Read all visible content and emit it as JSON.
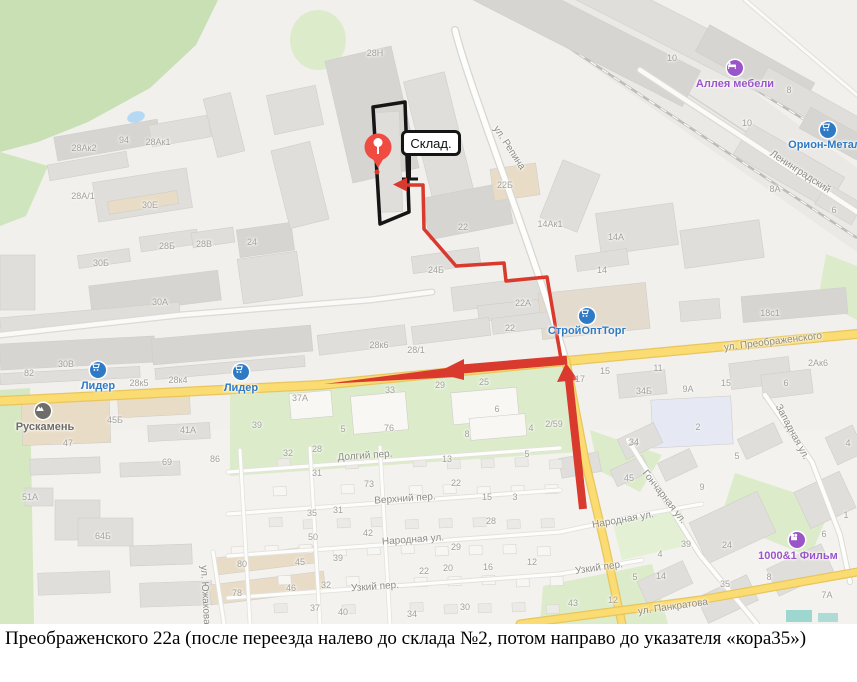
{
  "caption": "Преображенского 22а (после переезда налево до склада №2, потом направо до указателя «кора35»)",
  "map": {
    "warehouse_label": "Склад.",
    "marker": {
      "icon": "destination-pin-icon",
      "color": "#ef4b40"
    },
    "colors": {
      "route_red": "#d93a2d",
      "marker_red": "#ef4b40",
      "poi_blue": "#2f7ac4",
      "poi_purple": "#9a55c9",
      "poi_gray": "#6f6d6a",
      "road_yellow": "#fadc72",
      "green_area": "#d9ecc6"
    },
    "street_labels": [
      {
        "text": "ул. Репина",
        "x": 509,
        "y": 148,
        "angle": 57
      },
      {
        "text": "Ленинградский",
        "x": 800,
        "y": 172,
        "angle": 33
      },
      {
        "text": "ул. Преображенского",
        "x": 773,
        "y": 342,
        "angle": -7
      },
      {
        "text": "Западная ул.",
        "x": 792,
        "y": 432,
        "angle": 62
      },
      {
        "text": "Гончарная ул.",
        "x": 664,
        "y": 497,
        "angle": 52
      },
      {
        "text": "ул. Панкратова",
        "x": 673,
        "y": 607,
        "angle": -8
      },
      {
        "text": "Долгий пер.",
        "x": 365,
        "y": 456,
        "angle": -4
      },
      {
        "text": "Верхний пер.",
        "x": 405,
        "y": 499,
        "angle": -4
      },
      {
        "text": "Народная ул.",
        "x": 413,
        "y": 540,
        "angle": -4
      },
      {
        "text": "Народная ул.",
        "x": 623,
        "y": 520,
        "angle": -10
      },
      {
        "text": "Узкий пер.",
        "x": 375,
        "y": 587,
        "angle": -4
      },
      {
        "text": "Узкий пер.",
        "x": 599,
        "y": 568,
        "angle": -8
      },
      {
        "text": "ул. Южакова",
        "x": 205,
        "y": 595,
        "angle": 87
      }
    ],
    "poi_labels": [
      {
        "text": "Лидер",
        "x": 98,
        "y": 386,
        "ix": 98,
        "iy": 370,
        "color": "#2f7ac4",
        "icon": "cart-icon"
      },
      {
        "text": "Лидер",
        "x": 241,
        "y": 388,
        "ix": 241,
        "iy": 372,
        "color": "#2f7ac4",
        "icon": "cart-icon"
      },
      {
        "text": "СтройОптТорг",
        "x": 587,
        "y": 331,
        "ix": 587,
        "iy": 316,
        "color": "#2f7ac4",
        "icon": "cart-icon"
      },
      {
        "text": "Орион-Металл",
        "x": 828,
        "y": 145,
        "ix": 828,
        "iy": 130,
        "color": "#2f7ac4",
        "icon": "cart-icon"
      },
      {
        "text": "Аллея мебели",
        "x": 735,
        "y": 84,
        "ix": 735,
        "iy": 68,
        "color": "#9a55c9",
        "icon": "bed-icon"
      },
      {
        "text": "1000&1 Фильм",
        "x": 798,
        "y": 556,
        "ix": 797,
        "iy": 540,
        "color": "#9a55c9",
        "icon": "film-icon"
      },
      {
        "text": "Рускамень",
        "x": 45,
        "y": 427,
        "ix": 43,
        "iy": 411,
        "color": "#6f6d6a",
        "icon": "stone-icon"
      }
    ],
    "building_numbers": [
      {
        "text": "28Н",
        "x": 375,
        "y": 53
      },
      {
        "text": "10",
        "x": 672,
        "y": 58
      },
      {
        "text": "8",
        "x": 789,
        "y": 90
      },
      {
        "text": "10",
        "x": 747,
        "y": 123
      },
      {
        "text": "94",
        "x": 124,
        "y": 140
      },
      {
        "text": "28Ак2",
        "x": 84,
        "y": 148
      },
      {
        "text": "28Ак1",
        "x": 158,
        "y": 142
      },
      {
        "text": "28А/1",
        "x": 83,
        "y": 196
      },
      {
        "text": "30Е",
        "x": 150,
        "y": 205
      },
      {
        "text": "28Б",
        "x": 167,
        "y": 246
      },
      {
        "text": "28В",
        "x": 204,
        "y": 244
      },
      {
        "text": "24",
        "x": 252,
        "y": 242
      },
      {
        "text": "30Б",
        "x": 101,
        "y": 263
      },
      {
        "text": "30А",
        "x": 160,
        "y": 302
      },
      {
        "text": "8А",
        "x": 775,
        "y": 189
      },
      {
        "text": "6",
        "x": 834,
        "y": 210
      },
      {
        "text": "22Б",
        "x": 505,
        "y": 185
      },
      {
        "text": "22",
        "x": 463,
        "y": 227
      },
      {
        "text": "14Ак1",
        "x": 550,
        "y": 224
      },
      {
        "text": "14А",
        "x": 616,
        "y": 237
      },
      {
        "text": "24Б",
        "x": 436,
        "y": 270
      },
      {
        "text": "14",
        "x": 602,
        "y": 270
      },
      {
        "text": "22А",
        "x": 523,
        "y": 303
      },
      {
        "text": "22",
        "x": 510,
        "y": 328
      },
      {
        "text": "18с1",
        "x": 770,
        "y": 313
      },
      {
        "text": "30В",
        "x": 66,
        "y": 364
      },
      {
        "text": "82",
        "x": 29,
        "y": 373
      },
      {
        "text": "28к5",
        "x": 139,
        "y": 383
      },
      {
        "text": "28к4",
        "x": 178,
        "y": 380
      },
      {
        "text": "28к6",
        "x": 379,
        "y": 345
      },
      {
        "text": "28/1",
        "x": 416,
        "y": 350
      },
      {
        "text": "2Ак6",
        "x": 818,
        "y": 363
      },
      {
        "text": "45Б",
        "x": 115,
        "y": 420
      },
      {
        "text": "41А",
        "x": 188,
        "y": 430
      },
      {
        "text": "39",
        "x": 257,
        "y": 425
      },
      {
        "text": "47",
        "x": 68,
        "y": 443
      },
      {
        "text": "37А",
        "x": 300,
        "y": 398
      },
      {
        "text": "33",
        "x": 390,
        "y": 390
      },
      {
        "text": "29",
        "x": 440,
        "y": 385
      },
      {
        "text": "25",
        "x": 484,
        "y": 382
      },
      {
        "text": "5",
        "x": 343,
        "y": 429
      },
      {
        "text": "76",
        "x": 389,
        "y": 428
      },
      {
        "text": "6",
        "x": 497,
        "y": 409
      },
      {
        "text": "8",
        "x": 467,
        "y": 434
      },
      {
        "text": "4",
        "x": 531,
        "y": 428
      },
      {
        "text": "2/59",
        "x": 554,
        "y": 424
      },
      {
        "text": "17",
        "x": 580,
        "y": 379
      },
      {
        "text": "15",
        "x": 605,
        "y": 371
      },
      {
        "text": "11",
        "x": 658,
        "y": 368
      },
      {
        "text": "34Б",
        "x": 644,
        "y": 391
      },
      {
        "text": "9А",
        "x": 688,
        "y": 389
      },
      {
        "text": "15",
        "x": 726,
        "y": 383
      },
      {
        "text": "6",
        "x": 786,
        "y": 383
      },
      {
        "text": "2",
        "x": 698,
        "y": 427
      },
      {
        "text": "34",
        "x": 633,
        "y": 443
      },
      {
        "text": "4",
        "x": 848,
        "y": 443
      },
      {
        "text": "51А",
        "x": 30,
        "y": 497
      },
      {
        "text": "64Б",
        "x": 103,
        "y": 536
      },
      {
        "text": "69",
        "x": 167,
        "y": 462
      },
      {
        "text": "86",
        "x": 215,
        "y": 459
      },
      {
        "text": "32",
        "x": 288,
        "y": 453
      },
      {
        "text": "28",
        "x": 317,
        "y": 449
      },
      {
        "text": "13",
        "x": 447,
        "y": 459
      },
      {
        "text": "5",
        "x": 527,
        "y": 454
      },
      {
        "text": "31",
        "x": 317,
        "y": 473
      },
      {
        "text": "73",
        "x": 369,
        "y": 484
      },
      {
        "text": "22",
        "x": 456,
        "y": 483
      },
      {
        "text": "15",
        "x": 487,
        "y": 497
      },
      {
        "text": "3",
        "x": 515,
        "y": 497
      },
      {
        "text": "35",
        "x": 312,
        "y": 513
      },
      {
        "text": "31",
        "x": 338,
        "y": 510
      },
      {
        "text": "28",
        "x": 491,
        "y": 521
      },
      {
        "text": "42",
        "x": 368,
        "y": 533
      },
      {
        "text": "50",
        "x": 313,
        "y": 537
      },
      {
        "text": "29",
        "x": 456,
        "y": 547
      },
      {
        "text": "39",
        "x": 338,
        "y": 558
      },
      {
        "text": "45",
        "x": 300,
        "y": 562
      },
      {
        "text": "22",
        "x": 424,
        "y": 571
      },
      {
        "text": "20",
        "x": 448,
        "y": 568
      },
      {
        "text": "16",
        "x": 488,
        "y": 567
      },
      {
        "text": "12",
        "x": 532,
        "y": 562
      },
      {
        "text": "80",
        "x": 242,
        "y": 564
      },
      {
        "text": "78",
        "x": 237,
        "y": 593
      },
      {
        "text": "46",
        "x": 291,
        "y": 588
      },
      {
        "text": "32",
        "x": 326,
        "y": 585
      },
      {
        "text": "37",
        "x": 315,
        "y": 608
      },
      {
        "text": "40",
        "x": 343,
        "y": 612
      },
      {
        "text": "30",
        "x": 465,
        "y": 607
      },
      {
        "text": "34",
        "x": 412,
        "y": 614
      },
      {
        "text": "43",
        "x": 573,
        "y": 603
      },
      {
        "text": "12",
        "x": 613,
        "y": 600
      },
      {
        "text": "34",
        "x": 634,
        "y": 442
      },
      {
        "text": "45",
        "x": 629,
        "y": 478
      },
      {
        "text": "5",
        "x": 737,
        "y": 456
      },
      {
        "text": "9",
        "x": 702,
        "y": 487
      },
      {
        "text": "39",
        "x": 686,
        "y": 544
      },
      {
        "text": "4",
        "x": 660,
        "y": 554
      },
      {
        "text": "24",
        "x": 727,
        "y": 545
      },
      {
        "text": "5",
        "x": 635,
        "y": 577
      },
      {
        "text": "14",
        "x": 661,
        "y": 576
      },
      {
        "text": "35",
        "x": 725,
        "y": 584
      },
      {
        "text": "8",
        "x": 769,
        "y": 577
      },
      {
        "text": "6",
        "x": 824,
        "y": 534
      },
      {
        "text": "1",
        "x": 846,
        "y": 515
      },
      {
        "text": "7А",
        "x": 827,
        "y": 595
      }
    ]
  }
}
